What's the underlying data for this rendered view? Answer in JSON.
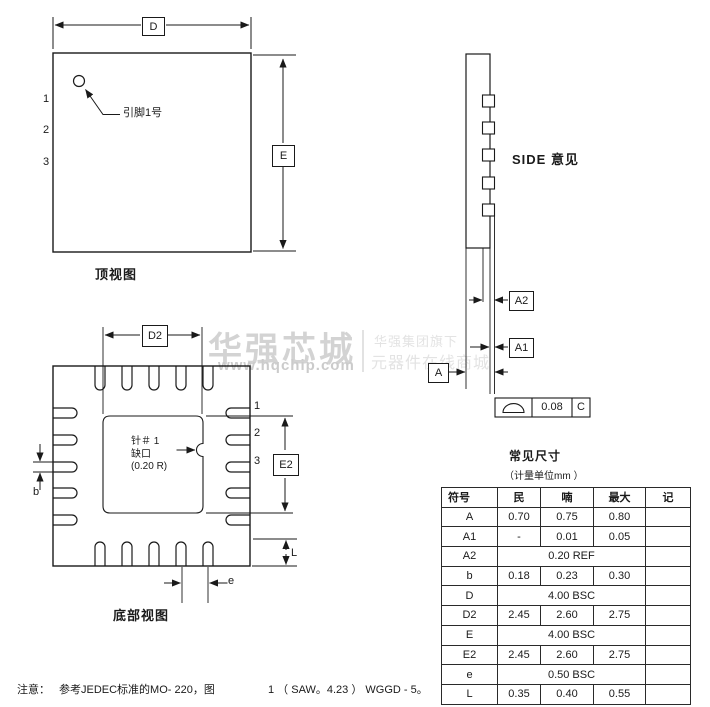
{
  "watermark": {
    "brand": "华强芯城",
    "url": "www.hqchip.com",
    "tagline1": "华强集团旗下",
    "tagline2": "元器件在线商城"
  },
  "top_view": {
    "title": "顶视图",
    "dim_d": "D",
    "dim_e": "E",
    "pin1_label": "引脚1号",
    "pins": [
      "1",
      "2",
      "3"
    ]
  },
  "side_view": {
    "title": "SIDE  意见",
    "dim_a": "A",
    "dim_a1": "A1",
    "dim_a2": "A2",
    "tol_value": "0.08",
    "tol_datum": "C"
  },
  "bottom_view": {
    "title": "底部视图",
    "dim_d2": "D2",
    "dim_e2": "E2",
    "dim_b": "b",
    "dim_e": "e",
    "dim_l": "L",
    "pins": [
      "1",
      "2",
      "3"
    ],
    "notch_line1": "针＃ 1",
    "notch_line2": "缺口",
    "notch_line3": "(0.20 R)"
  },
  "table": {
    "title": "常见尺寸",
    "subtitle": "（计量单位mm ）",
    "headers": [
      "符号",
      "民",
      "喃",
      "最大",
      "记"
    ],
    "rows": [
      {
        "sym": "A",
        "min": "0.70",
        "nom": "0.75",
        "max": "0.80",
        "note": ""
      },
      {
        "sym": "A1",
        "min": "-",
        "nom": "0.01",
        "max": "0.05",
        "note": ""
      },
      {
        "sym": "A2",
        "span": "0.20 REF",
        "note": ""
      },
      {
        "sym": "b",
        "min": "0.18",
        "nom": "0.23",
        "max": "0.30",
        "note": ""
      },
      {
        "sym": "D",
        "span": "4.00 BSC",
        "note": ""
      },
      {
        "sym": "D2",
        "min": "2.45",
        "nom": "2.60",
        "max": "2.75",
        "note": ""
      },
      {
        "sym": "E",
        "span": "4.00 BSC",
        "note": ""
      },
      {
        "sym": "E2",
        "min": "2.45",
        "nom": "2.60",
        "max": "2.75",
        "note": ""
      },
      {
        "sym": "e",
        "span": "0.50 BSC",
        "note": ""
      },
      {
        "sym": "L",
        "min": "0.35",
        "nom": "0.40",
        "max": "0.55",
        "note": ""
      }
    ]
  },
  "note": {
    "label": "注意：",
    "part1": "参考JEDEC标准的MO- 220，图",
    "part2": "1 （ SAW。4.23 ）  WGGD - 5。"
  }
}
